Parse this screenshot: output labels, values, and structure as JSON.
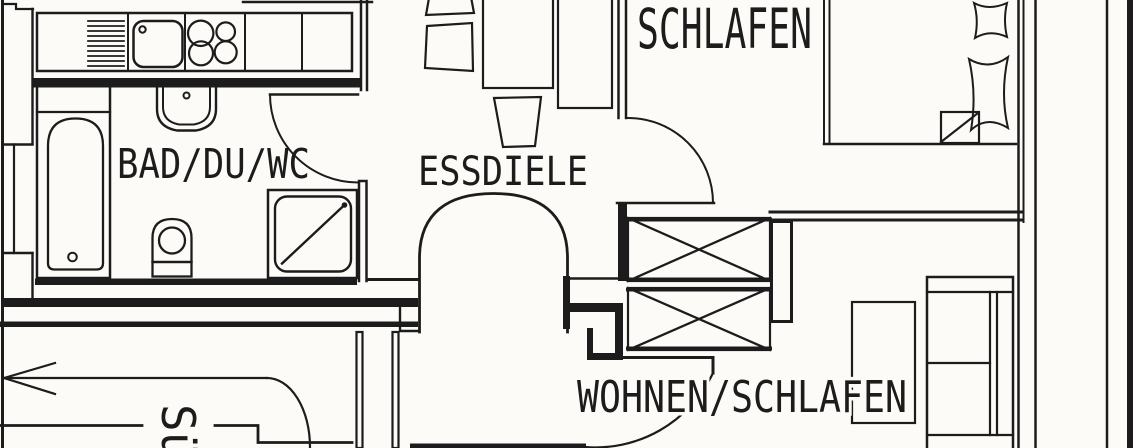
{
  "document": {
    "type": "apartment floor plan (scanned blueprint)",
    "background_color": "#fcfbf8",
    "ink_color": "#1c1c1c"
  },
  "rooms": {
    "bathroom": {
      "label": "BAD/DU/WC"
    },
    "dining_hall": {
      "label": "ESSDIELE"
    },
    "bedroom": {
      "label": "SCHLAFEN"
    },
    "living_bedroom": {
      "label": "WOHNEN/SCHLAFEN"
    },
    "balcony": {
      "label_visible": "Sü"
    }
  },
  "fixtures": {
    "kitchen": [
      "kitchen-counter",
      "drainer-hatch",
      "kitchen-sink",
      "stove-burners"
    ],
    "bathroom": [
      "bathtub",
      "washbasin",
      "toilet",
      "shower"
    ],
    "dining_hall": [
      "dining-table",
      "sideboard",
      "chairs",
      "arched-opening"
    ],
    "bedroom": [
      "double-bed",
      "pillows",
      "folded-blanket"
    ],
    "living_bedroom": [
      "sofa-bed",
      "side-table",
      "wardrobe-1",
      "wardrobe-2"
    ],
    "balcony": [
      "direction-arrow"
    ],
    "doors": [
      "bathroom-door-swing",
      "bedroom-door-swing",
      "living-room-door-swing"
    ]
  }
}
